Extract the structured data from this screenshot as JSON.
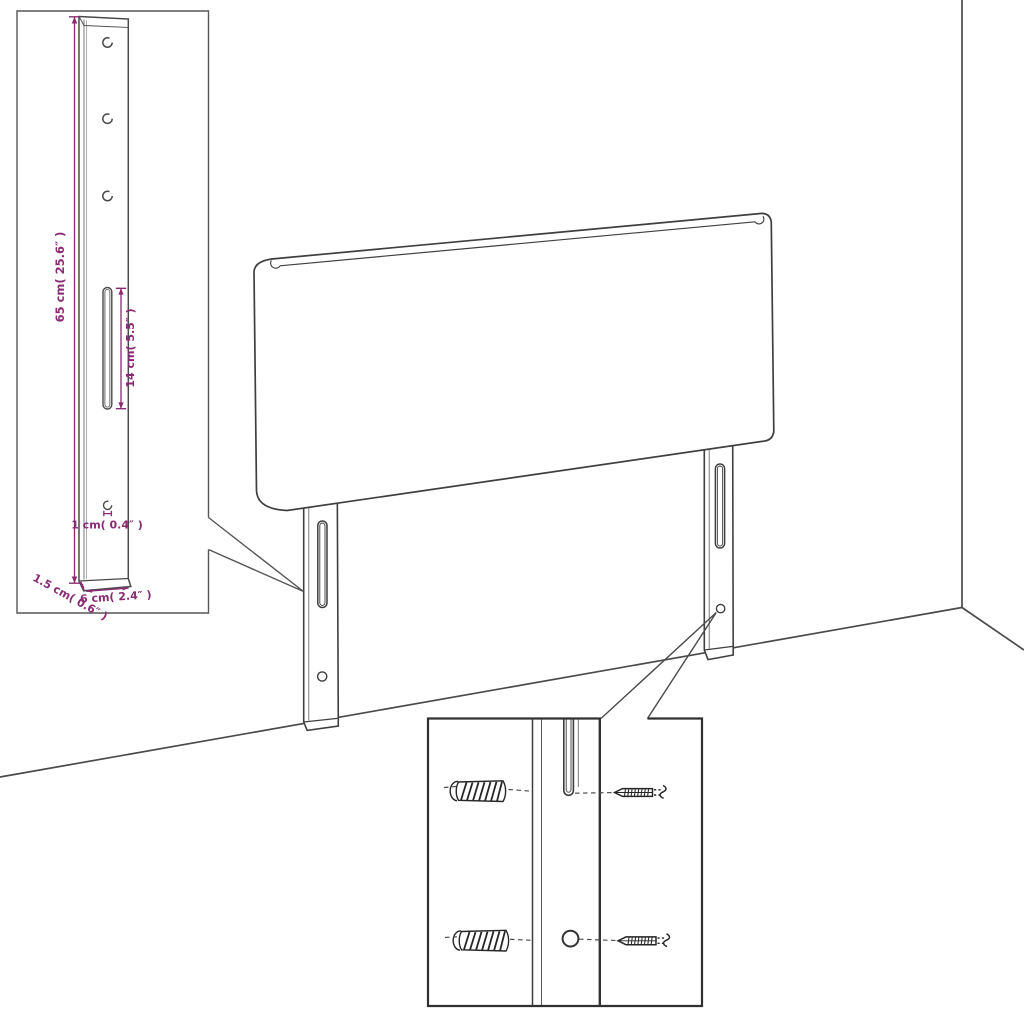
{
  "diagram": {
    "type": "furniture-dimension-line-drawing",
    "subject": "headboard-with-mounting-legs",
    "colors": {
      "outline": "#3f3f3f",
      "inset_border": "#565656",
      "hardware_ink": "#262626",
      "dimension_magenta": "#8a2a74",
      "background": "#ffffff"
    },
    "leg_detail_inset": {
      "height_label": "65 cm( 25.6″ )",
      "slot_label": "14 cm( 5.5″ )",
      "hole_label": "1 cm( 0.4″ )",
      "depth_label": "1.5 cm( 0.6″ )",
      "width_label": "6 cm( 2.4″ )",
      "mount_holes_visible": 3
    },
    "hardware_detail_inset": {
      "rows": 2,
      "parts": [
        "wall-plug",
        "leg-slot",
        "screw"
      ]
    }
  }
}
